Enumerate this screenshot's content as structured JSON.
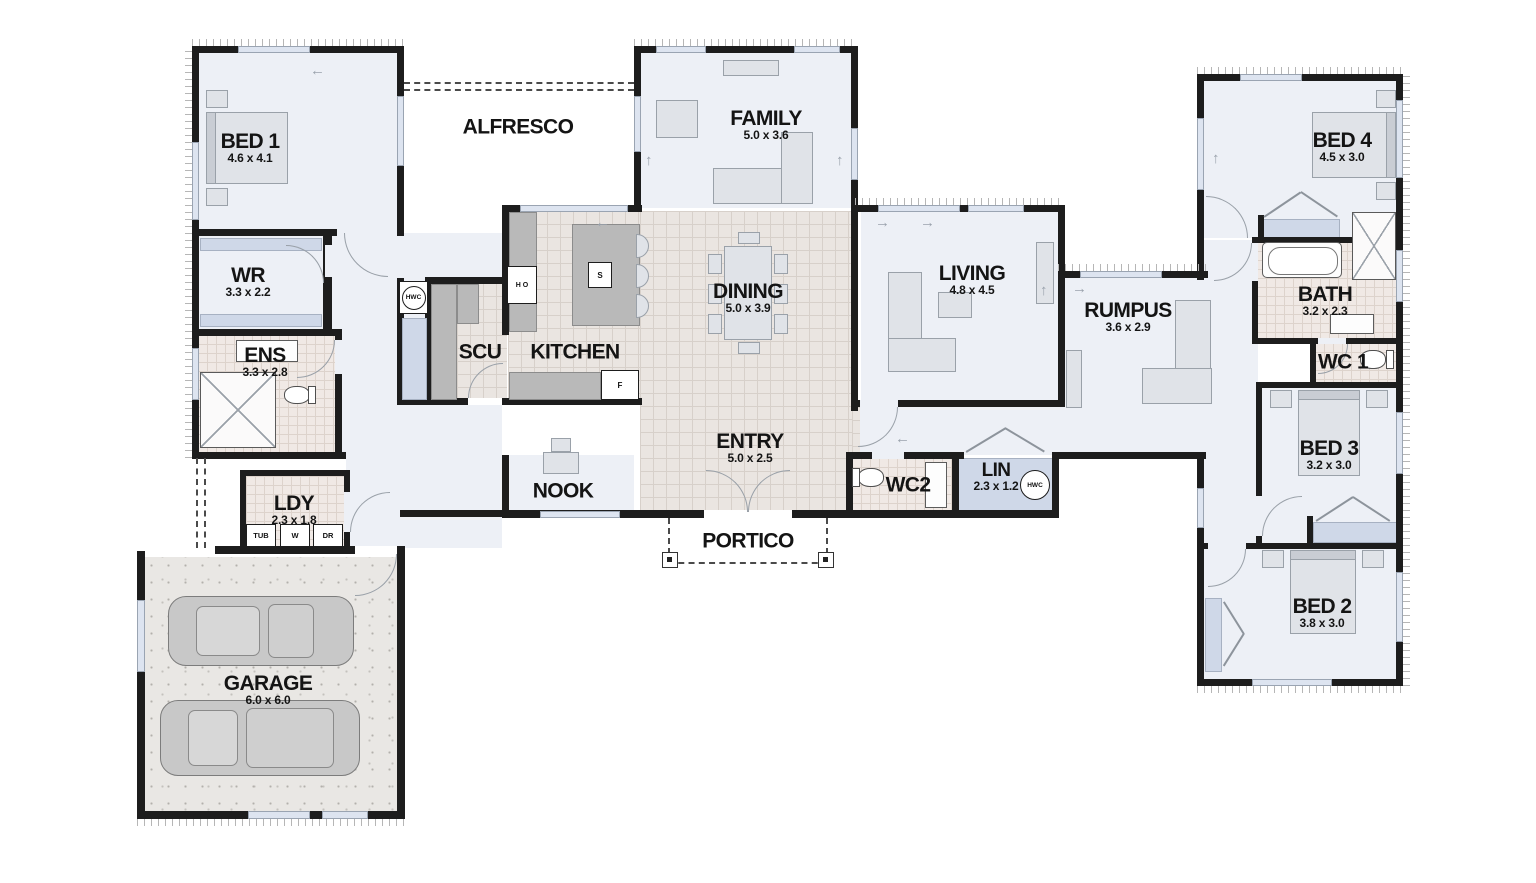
{
  "title": "Single storey house floor plan",
  "rooms": {
    "bed1": {
      "label": "BED 1",
      "dims": "4.6 x 4.1"
    },
    "wr": {
      "label": "WR",
      "dims": "3.3 x 2.2"
    },
    "ens": {
      "label": "ENS",
      "dims": "3.3 x 2.8"
    },
    "ldy": {
      "label": "LDY",
      "dims": "2.3 x 1.8"
    },
    "garage": {
      "label": "GARAGE",
      "dims": "6.0 x 6.0"
    },
    "alfresco": {
      "label": "ALFRESCO",
      "dims": ""
    },
    "family": {
      "label": "FAMILY",
      "dims": "5.0 x 3.6"
    },
    "scu": {
      "label": "SCU",
      "dims": ""
    },
    "kitchen": {
      "label": "KITCHEN",
      "dims": ""
    },
    "dining": {
      "label": "DINING",
      "dims": "5.0 x 3.9"
    },
    "nook": {
      "label": "NOOK",
      "dims": ""
    },
    "entry": {
      "label": "ENTRY",
      "dims": "5.0 x 2.5"
    },
    "portico": {
      "label": "PORTICO",
      "dims": ""
    },
    "wc2": {
      "label": "WC2",
      "dims": ""
    },
    "lin": {
      "label": "LIN",
      "dims": "2.3 x 1.2"
    },
    "living": {
      "label": "LIVING",
      "dims": "4.8 x 4.5"
    },
    "rumpus": {
      "label": "RUMPUS",
      "dims": "3.6 x 2.9"
    },
    "bed4": {
      "label": "BED 4",
      "dims": "4.5 x 3.0"
    },
    "bath": {
      "label": "BATH",
      "dims": "3.2 x 2.3"
    },
    "wc1": {
      "label": "WC 1",
      "dims": ""
    },
    "bed3": {
      "label": "BED 3",
      "dims": "3.2 x 3.0"
    },
    "bed2": {
      "label": "BED 2",
      "dims": "3.8 x 3.0"
    }
  },
  "fixtures": {
    "hwc_hall": "HWC",
    "hwc_lin": "HWC",
    "tub": "TUB",
    "washer": "W",
    "dryer": "DR",
    "hob": "H O",
    "sink": "S",
    "fridge": "F"
  },
  "colors": {
    "wall": "#1d1d1d",
    "floor": "#edf0f6",
    "tile": "#eae5e1",
    "bath_tile": "#f0e9e5",
    "window": "#dde4f0",
    "furniture": "#e0e3e8",
    "bench": "#b9b9b9"
  }
}
